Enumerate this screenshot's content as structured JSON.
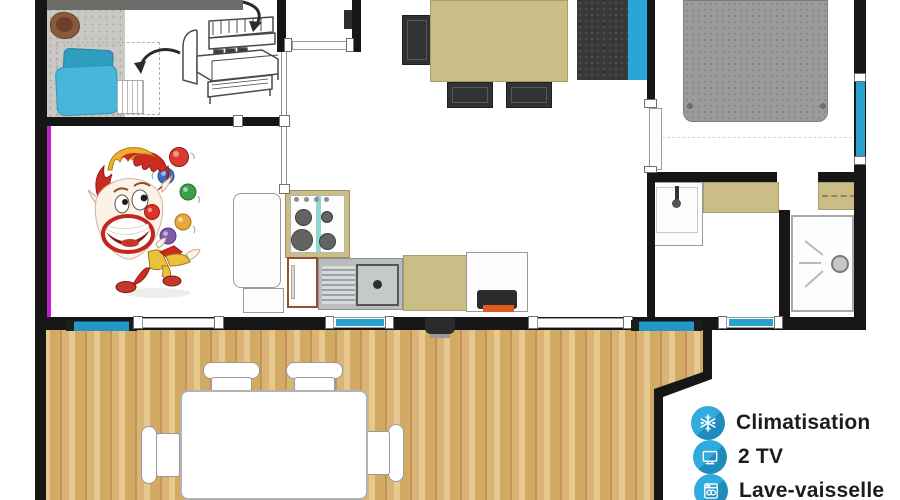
{
  "plan": {
    "type": "mobile-home floor plan with terrace",
    "legend": {
      "items": [
        {
          "icon": "snowflake-icon",
          "label": "Climatisation"
        },
        {
          "icon": "tv-icon",
          "label": "2 TV"
        },
        {
          "icon": "dishwasher-icon",
          "label": "Lave-vaisselle"
        }
      ]
    },
    "colors": {
      "accent_blue": "#2aa6d8",
      "icon_blue": "#2fabdd",
      "icon_blue_shadow": "#1f8cbd",
      "window_blue": "#2aa0cf",
      "counter_tan": "#cabd85",
      "deck_wood": "#d9b476",
      "wall_black": "#161616",
      "magenta_accent": "#bf1fd0",
      "pillow_light": "#46b6dc",
      "pillow_dark": "#2f9dbe",
      "bed_gray": "#9b9b99"
    }
  }
}
